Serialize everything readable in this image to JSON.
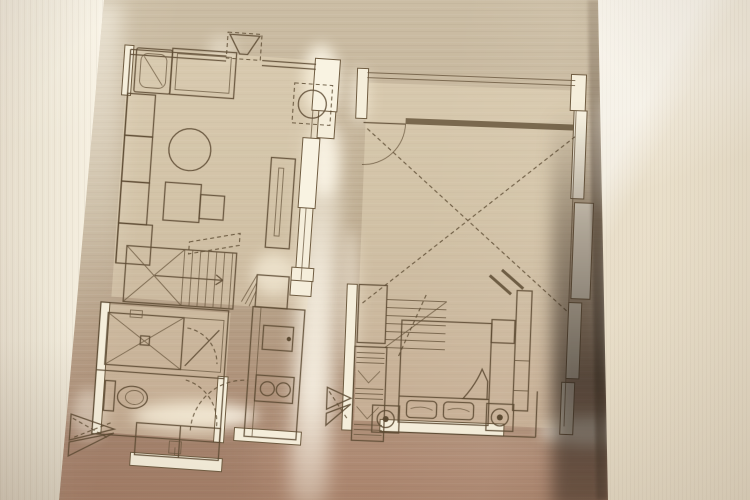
{
  "scene": {
    "description": "Photograph of a two-level apartment floor plan laser-cut and etched into a brushed bronze metal panel, mounted beside cream textured wallpaper walls",
    "panel_material": "brushed bronze metal",
    "plans_count": 2
  },
  "palette": {
    "wallpaper_left": "#ece5d4",
    "wallpaper_right": "#e9dfca",
    "metal_top": "#cbbda4",
    "metal_mid": "#bfae93",
    "metal_bottom": "#a9876f",
    "line_dark": "#5d4b33",
    "wall_cut_glow": "#f5eedb",
    "edge_shadow": "#42332a"
  },
  "plans": [
    {
      "name": "lower-floor-plan",
      "position": "left",
      "rooms": [
        "living-area",
        "staircase",
        "bathroom",
        "toilet",
        "kitchen",
        "entry"
      ],
      "symbols": [
        "sofa-cushion",
        "lounge-chaise",
        "storage-cabinets",
        "round-table",
        "side-tables",
        "tv-cabinet",
        "washing-machine",
        "exhaust-vent",
        "stair-treads",
        "shower-with-drain",
        "toilet-bowl",
        "vanity-basin",
        "refrigerator",
        "kitchen-sink",
        "two-burner-cooktop",
        "entry-door-swing",
        "section-markers"
      ]
    },
    {
      "name": "upper-floor-plan",
      "position": "right",
      "rooms": [
        "bedroom",
        "void-over-living",
        "staircase",
        "wardrobe",
        "balcony-rail"
      ],
      "symbols": [
        "double-bed",
        "pillows",
        "folded-blanket",
        "bedside-lamps",
        "hanging-rail-marks",
        "desk-counter",
        "side-table",
        "door-swing",
        "void-cross-dashed",
        "stair-treads",
        "section-markers"
      ]
    }
  ]
}
